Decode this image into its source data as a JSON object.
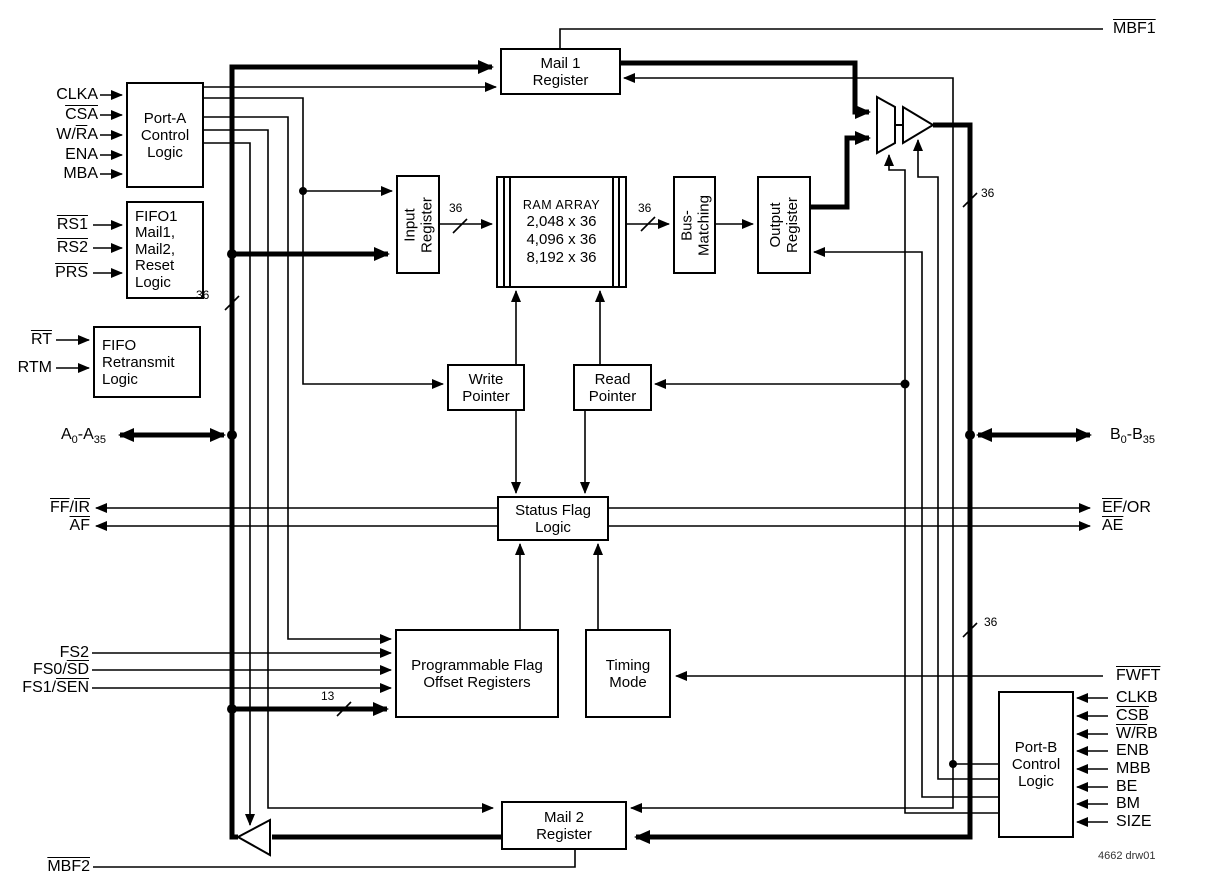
{
  "boxes": {
    "port_a": [
      "Port-A",
      "Control",
      "Logic"
    ],
    "reset": [
      "FIFO1",
      "Mail1,",
      "Mail2,",
      "Reset",
      "Logic"
    ],
    "retransmit": [
      "FIFO",
      "Retransmit",
      "Logic"
    ],
    "mail1": [
      "Mail 1",
      "Register"
    ],
    "input_reg": [
      "Input",
      "Register"
    ],
    "ram": [
      "RAM ARRAY",
      "2,048 x 36",
      "4,096 x 36",
      "8,192 x 36"
    ],
    "bus_matching": [
      "Bus-",
      "Matching"
    ],
    "output_reg": [
      "Output",
      "Register"
    ],
    "write_ptr": [
      "Write",
      "Pointer"
    ],
    "read_ptr": [
      "Read",
      "Pointer"
    ],
    "status_flag": [
      "Status Flag",
      "Logic"
    ],
    "pfor": [
      "Programmable Flag",
      "Offset Registers"
    ],
    "timing": [
      "Timing",
      "Mode"
    ],
    "mail2": [
      "Mail 2",
      "Register"
    ],
    "port_b": [
      "Port-B",
      "Control",
      "Logic"
    ]
  },
  "signals": {
    "clka": "CLKA",
    "csa": "CSA",
    "wra": {
      "pre": "W/",
      "ov": "R",
      "post": "A"
    },
    "ena": "ENA",
    "mba": "MBA",
    "rs1": "RS1",
    "rs2": "RS2",
    "prs": "PRS",
    "rt": "RT",
    "rtm": "RTM",
    "a_bus": {
      "p1": "A",
      "s1": "0",
      "p2": "-A",
      "s2": "35"
    },
    "ffir": {
      "ov1": "FF",
      "sep": "/",
      "ov2": "IR"
    },
    "af": "AF",
    "fs2": "FS2",
    "fs0": {
      "pre": "FS0/",
      "ov": "SD"
    },
    "fs1": {
      "pre": "FS1/",
      "ov": "SEN"
    },
    "mbf2": "MBF2",
    "mbf1": "MBF1",
    "b_bus": {
      "p1": "B",
      "s1": "0",
      "p2": "-B",
      "s2": "35"
    },
    "efor": {
      "ov": "EF",
      "post": "/OR"
    },
    "ae": "AE",
    "fwft": "FWFT",
    "clkb": "CLKB",
    "csb": "CSB",
    "wrb": {
      "ov": "W/R",
      "post": "B"
    },
    "enb": "ENB",
    "mbb": "MBB",
    "be": "BE",
    "bm": "BM",
    "size": "SIZE"
  },
  "bus_widths": {
    "data": "36",
    "offset": "13"
  },
  "note": "4662 drw01",
  "colors": {
    "line": "#000000",
    "background": "#ffffff"
  }
}
